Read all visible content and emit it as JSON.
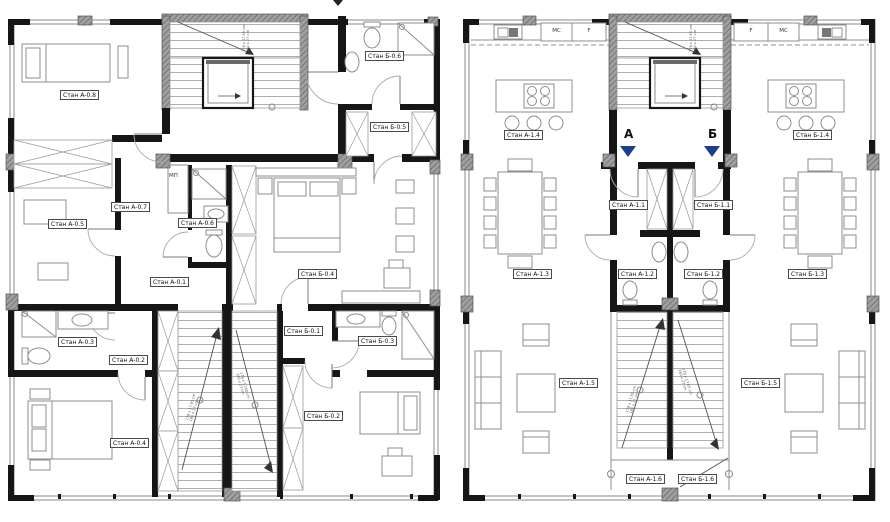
{
  "palette": {
    "wall": "#161616",
    "column_hatch": "#8f8f8f",
    "furniture_line": "#8c8c8c",
    "window_line": "#8a8a8a",
    "door_line": "#ababab",
    "marker_blue": "#1d3d8f",
    "label_border": "#4a4a4a"
  },
  "left_plan": {
    "rooms": {
      "a01": "Стан А-0.1",
      "a02": "Стан А-0.2",
      "a03": "Стан А-0.3",
      "a04": "Стан А-0.4",
      "a05": "Стан А-0.5",
      "a06": "Стан А-0.6",
      "a07": "Стан А-0.7",
      "a08": "Стан А-0.8",
      "b01": "Стан Б-0.1",
      "b02": "Стан Б-0.2",
      "b03": "Стан Б-0.3",
      "b04": "Стан Б-0.4",
      "b05": "Стан Б-0.5",
      "b06": "Стан Б-0.6"
    },
    "closet_label": "МП"
  },
  "right_plan": {
    "rooms": {
      "a11": "Стан А-1.1",
      "a12": "Стан А-1.2",
      "a13": "Стан А-1.3",
      "a14": "Стан А-1.4",
      "a15": "Стан А-1.5",
      "a16": "Стан А-1.6",
      "b11": "Стан Б-1.1",
      "b12": "Стан Б-1.2",
      "b13": "Стан Б-1.3",
      "b14": "Стан Б-1.4",
      "b15": "Стан Б-1.5",
      "b16": "Стан Б-1.6"
    },
    "kitchen_cabinets": {
      "mc": "МС",
      "f": "F"
    },
    "section_markers": {
      "a": "А",
      "b": "Б"
    }
  },
  "stairs": {
    "dim_line1": "178 x 17.65 cm",
    "dim_line2": "180 x 27 cm"
  }
}
